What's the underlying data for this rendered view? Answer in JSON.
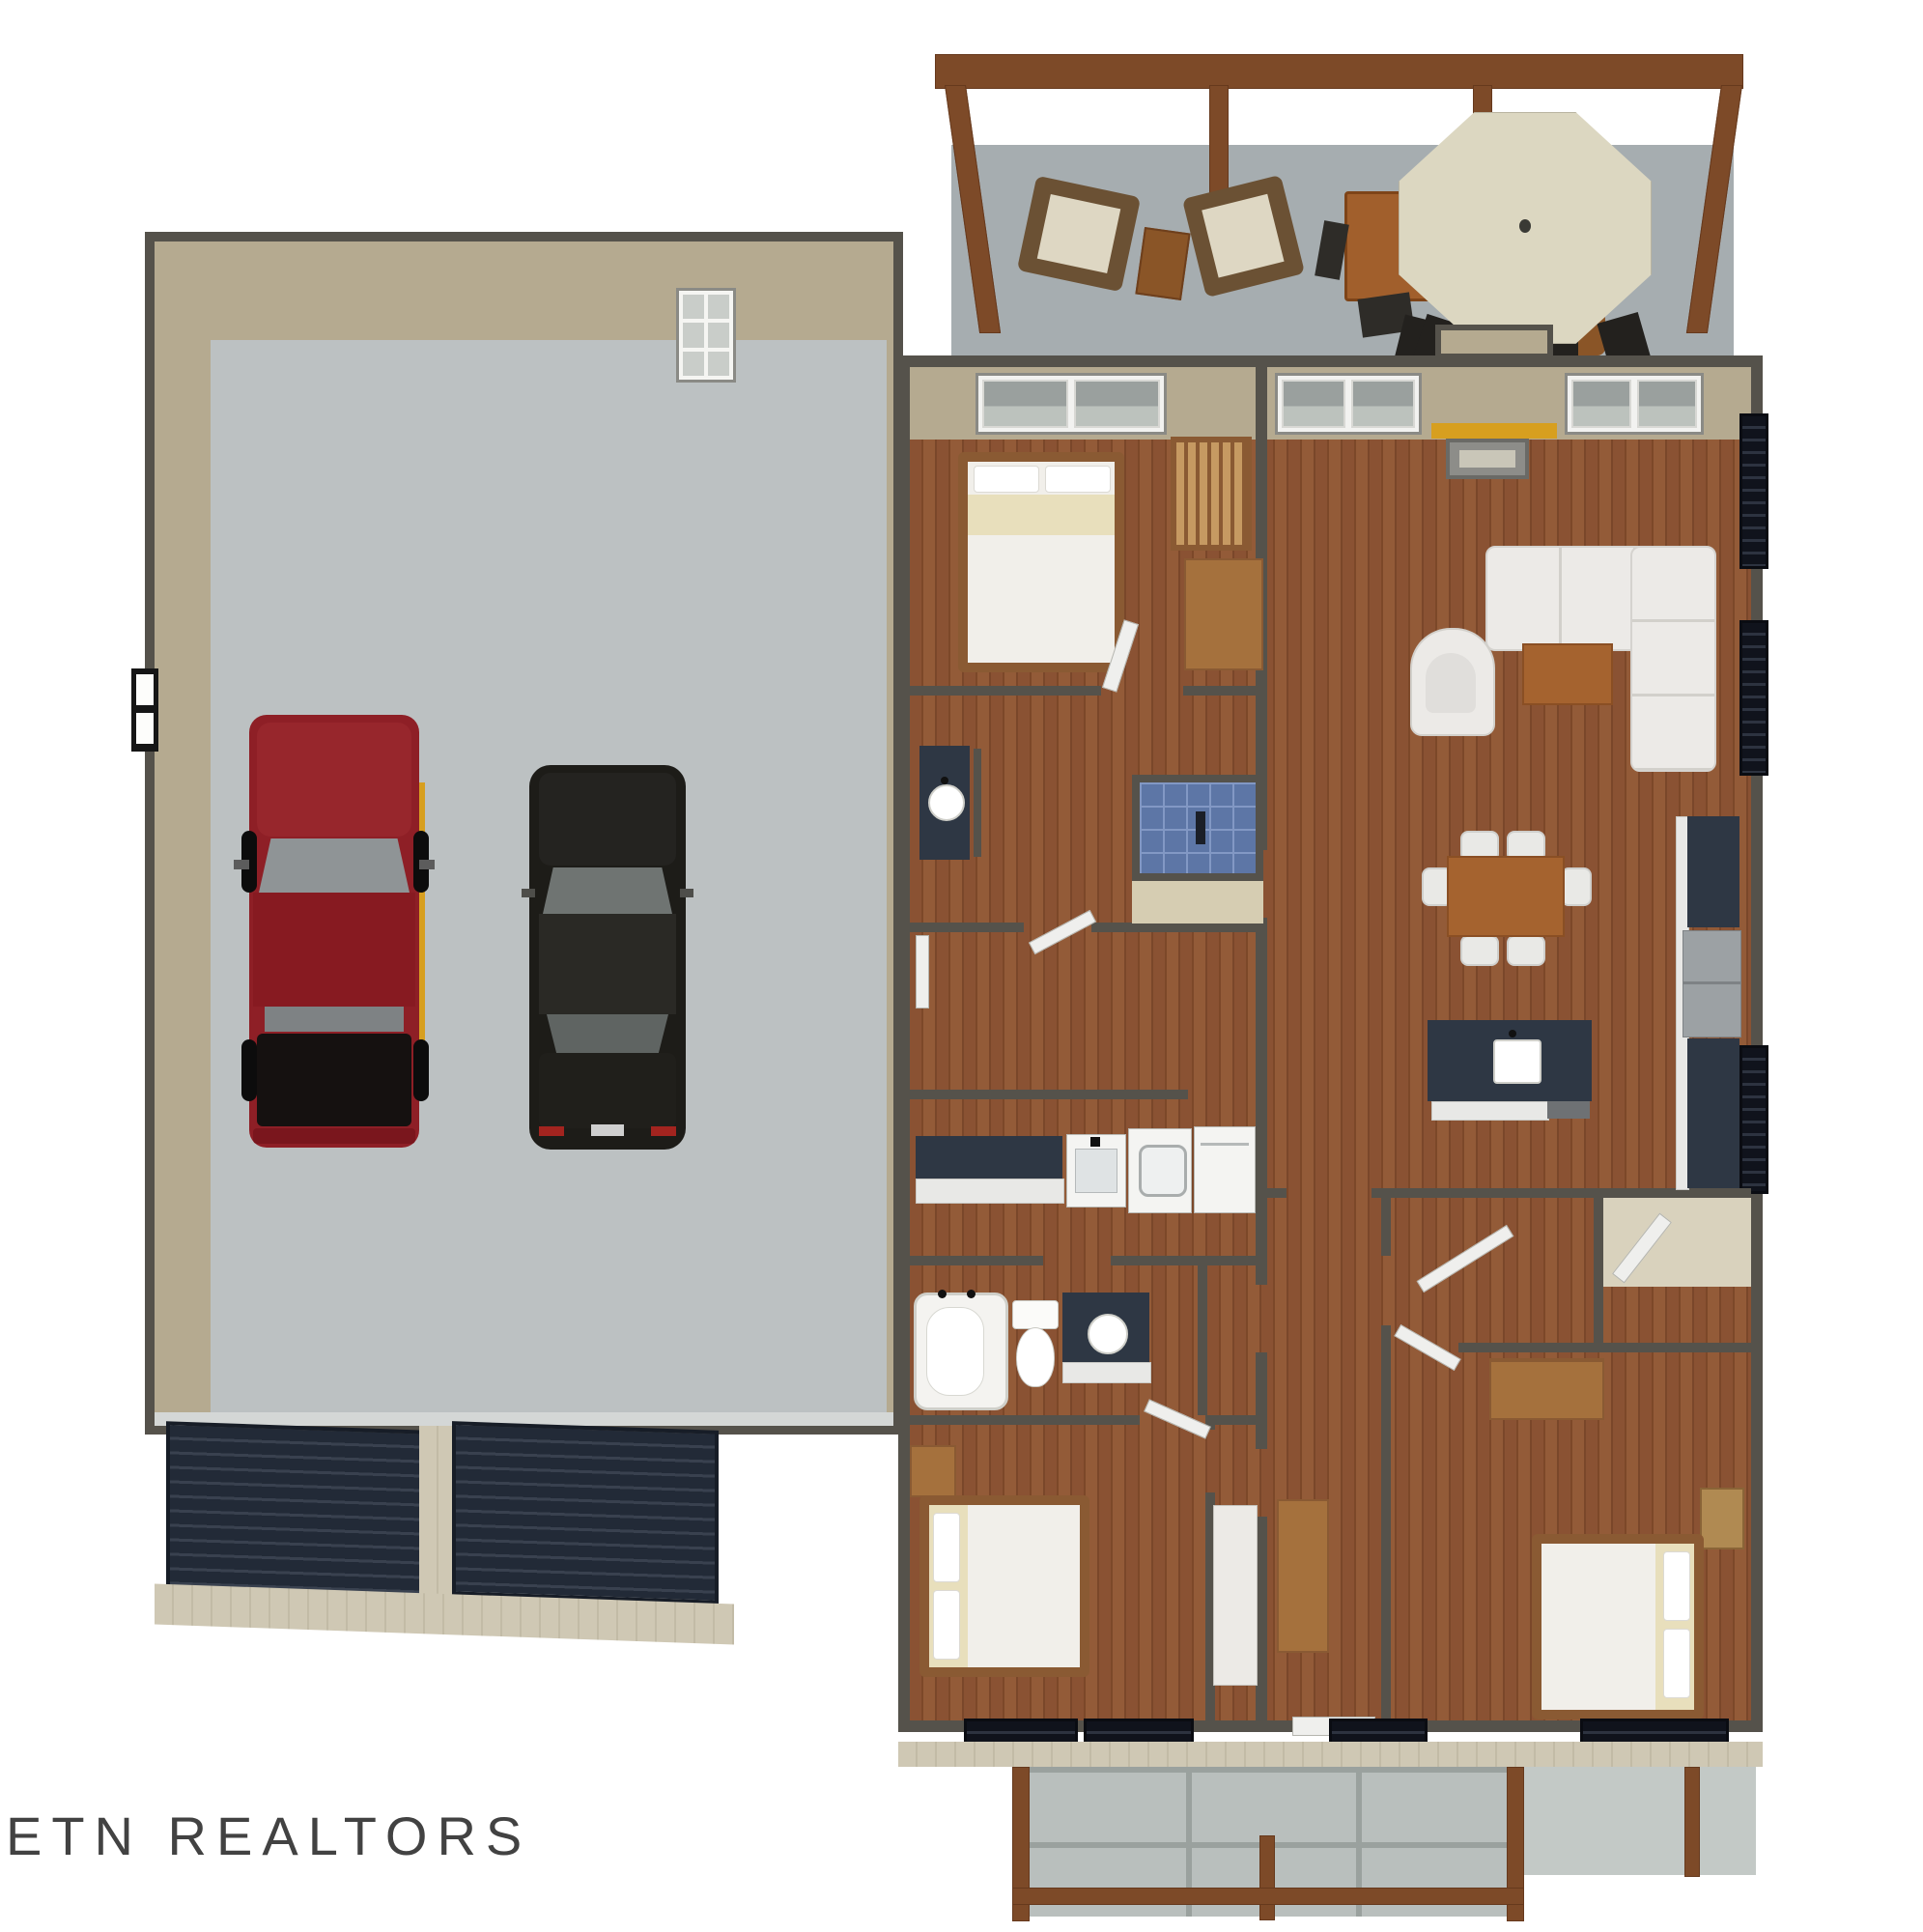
{
  "image": {
    "kind": "3d-floor-plan-rendering",
    "view": "overhead dollhouse view, single story home with attached garage",
    "background": "#ffffff"
  },
  "watermark": {
    "text": "ETN REALTORS"
  },
  "palette": {
    "wall_stroke": "#55524b",
    "wall_face_tan": "#b5aa90",
    "wood_floor": "#8a5233",
    "garage_concrete": "#bcc1c2",
    "deck_concrete": "#a6adb0",
    "porch_concrete": "#b9bfbd",
    "pergola_wood": "#7d4a28",
    "furniture_wood": "#a5713d",
    "table_wood": "#a5632f",
    "counter_dark": "#2e3744",
    "cabinet_white": "#e8e8e6",
    "appliance_white": "#f4f4f2",
    "appliance_gray": "#9ca1a4",
    "shower_tile_blue": "#5d76a6",
    "bath_tile_beige": "#d6cdb2",
    "upholstery_white": "#eceae7",
    "bedding_white": "#f1efea",
    "bedding_cream": "#e8dfbc",
    "truck_red": "#8e1f26",
    "car_black": "#1d1c18",
    "garage_door_dark": "#222a37",
    "siding_beige": "#cfc8b4",
    "umbrella_cream": "#dcd7c1",
    "mantel_yellow": "#d79f1f",
    "window_glass": "#9aa09e",
    "dark_window": "#10131c"
  },
  "scene": {
    "deck": {
      "features": [
        "wood pergola frame with posts",
        "two cushioned armchairs",
        "wood side table",
        "tall bar table with stools",
        "large octagonal patio umbrella",
        "outdoor dining table with chairs"
      ]
    },
    "garage": {
      "vehicles": [
        "red pickup truck",
        "black sedan"
      ],
      "features": [
        "two dark roll-up garage doors",
        "side window",
        "white back door"
      ]
    },
    "house": {
      "rooms": [
        "bedroom 1 with bed and crib",
        "master bathroom with blue tiled shower and vanity",
        "walk-in closet",
        "laundry room with counter, utility sink, washer and dryer",
        "hall bathroom with tub, toilet and vanity",
        "bedroom 2",
        "great room with sectional sofa, accent chair, coffee table and fireplace",
        "dining area with table and six chairs",
        "kitchen with island sink, range, refrigerator and counters",
        "pantry",
        "central hallway",
        "foyer with cabinet and front door",
        "bedroom 3 with bed, dresser and nightstand"
      ]
    },
    "porch": {
      "features": [
        "concrete slab with grid joints",
        "wood posts",
        "wood railing"
      ]
    }
  }
}
